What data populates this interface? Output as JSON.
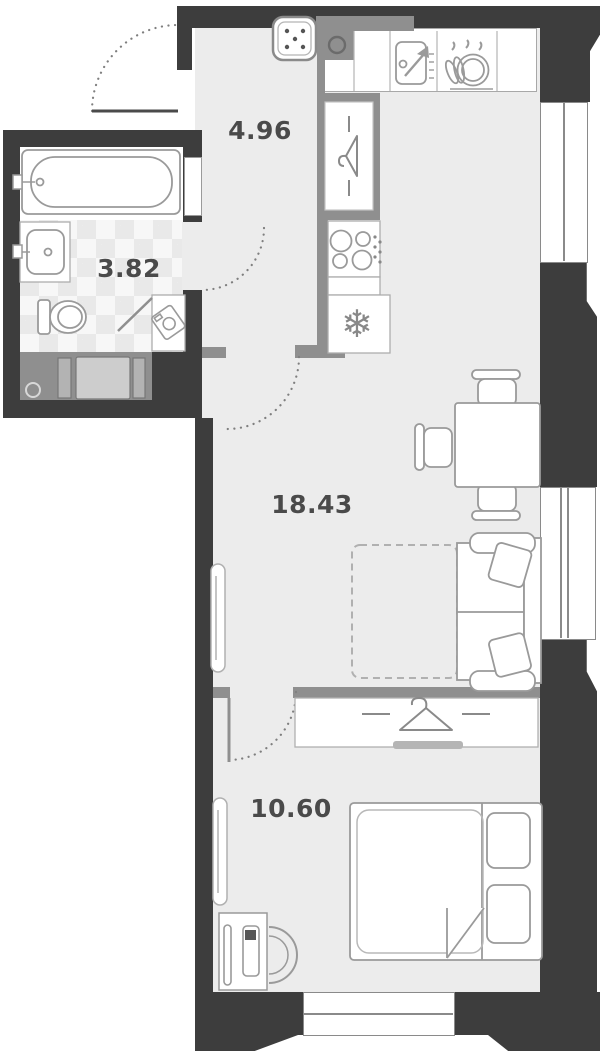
{
  "plan": {
    "type": "apartment-floor-plan",
    "rooms": {
      "hallway": {
        "label": "4.96"
      },
      "bathroom": {
        "label": "3.82"
      },
      "living_kitchen": {
        "label": "18.43"
      },
      "bedroom": {
        "label": "10.60"
      }
    },
    "fixtures": [
      "entry-door-swing",
      "vent-hatch",
      "hallway-wardrobe-hanger",
      "kitchen-counter",
      "kitchen-sink",
      "dish-dryer",
      "hob",
      "fridge-snowflake",
      "bathtub",
      "washbasin",
      "toilet",
      "washing-machine",
      "utility-shaft",
      "dining-table",
      "dining-chairs",
      "sofa",
      "sofa-fold-out-extension",
      "radiator-living",
      "radiator-bedroom",
      "bedroom-wardrobe-hanger",
      "double-bed",
      "bed-pillows",
      "desk",
      "laptop",
      "desk-chair",
      "window-right-upper",
      "window-right-lower",
      "window-bottom",
      "bathroom-door-swing",
      "living-door-swing",
      "bedroom-door-swing"
    ],
    "colors": {
      "outer_wall": "#3d3d3d",
      "partition": "#8f8f8f",
      "floor": "#ececec",
      "fixture_outline": "#9a9a9a",
      "label_text": "#4a4a4a"
    }
  }
}
